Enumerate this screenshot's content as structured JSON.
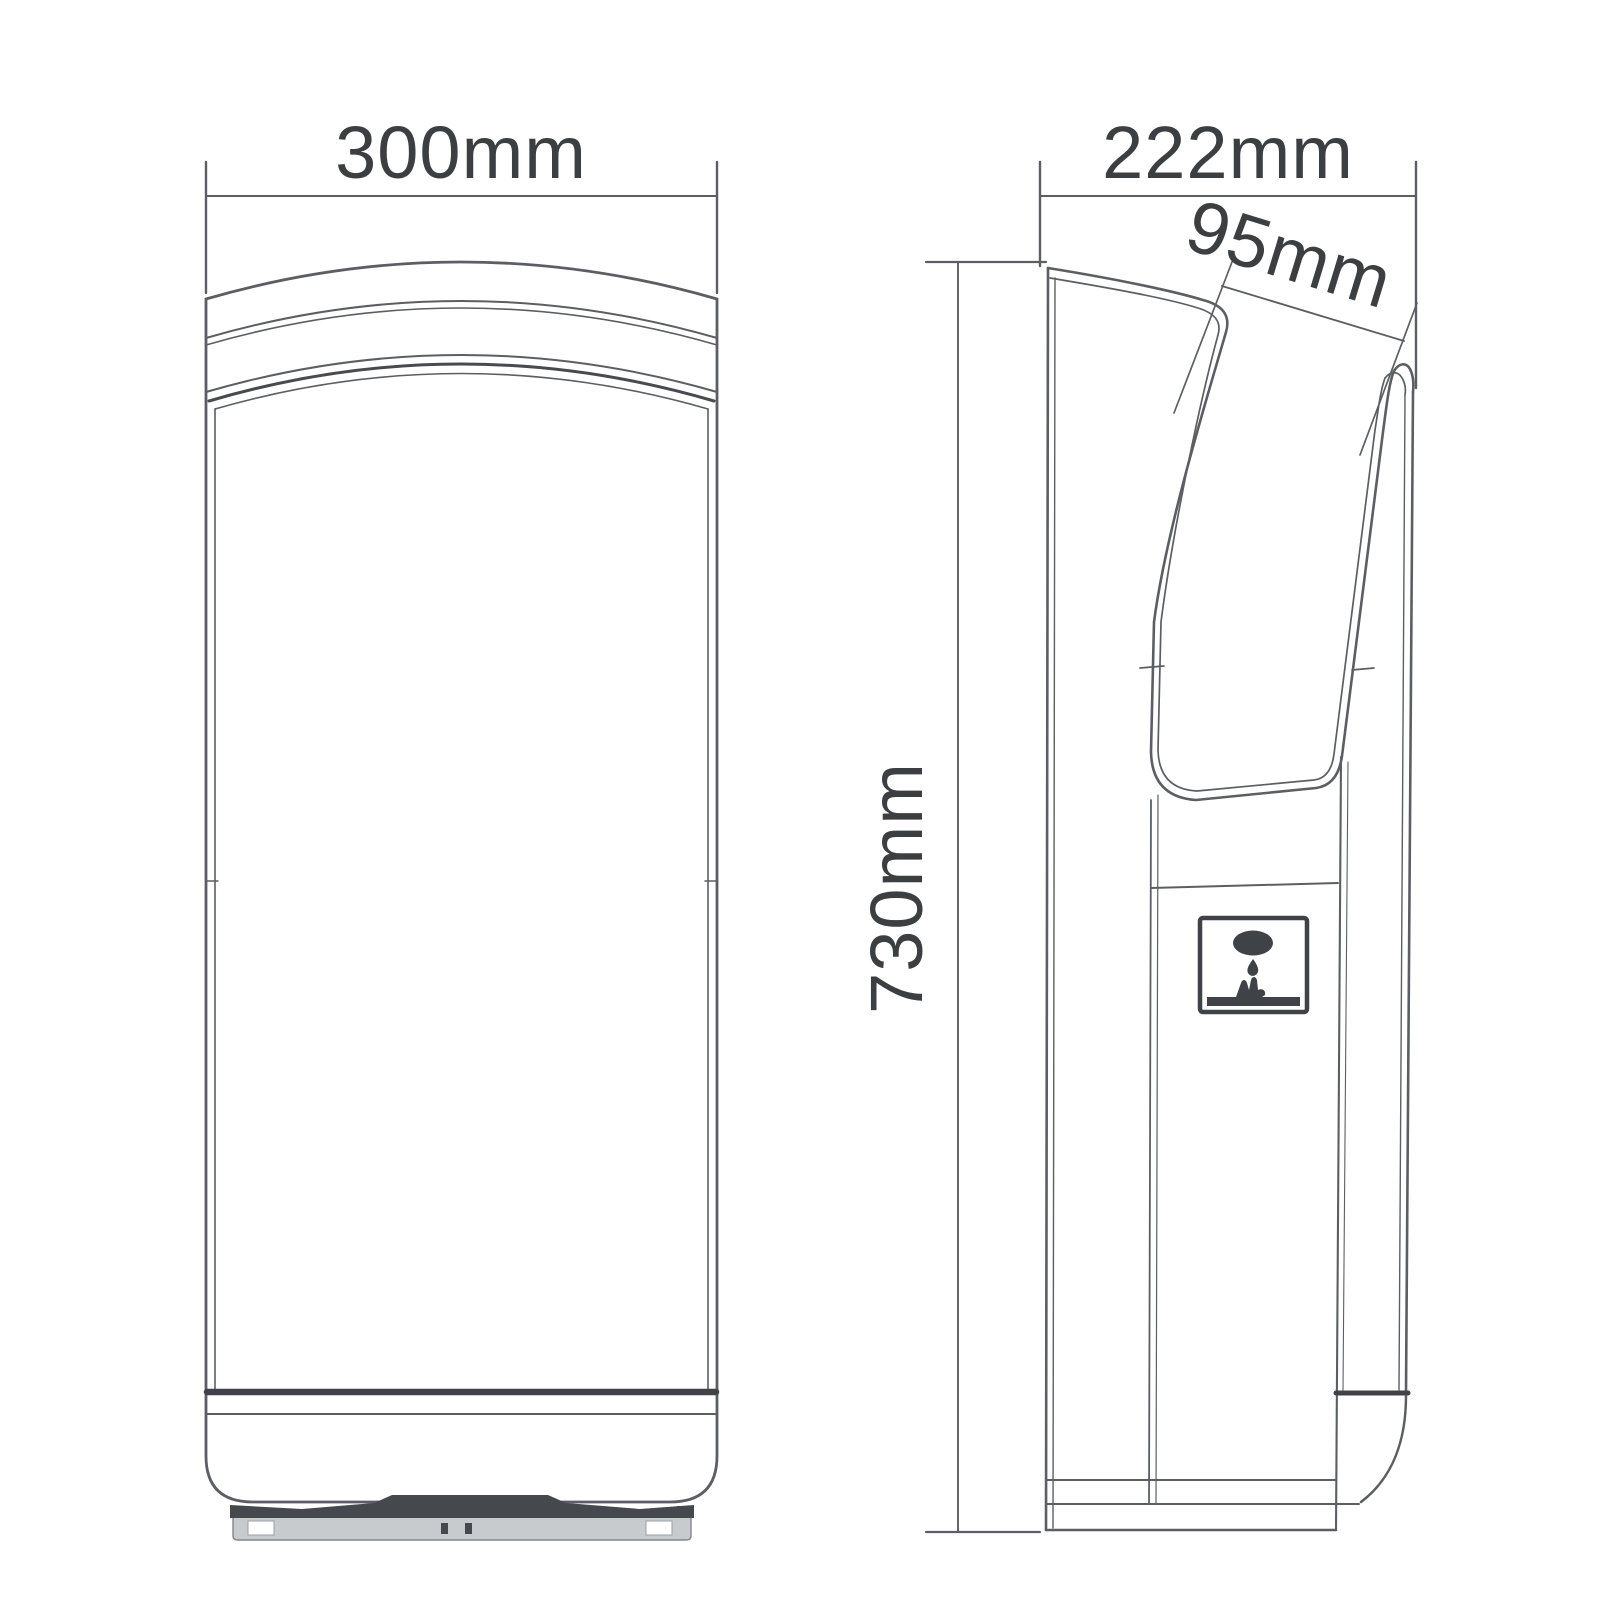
{
  "diagram": {
    "type": "technical-drawing",
    "subject": "jet hand dryer - front and side elevation views with dimensions",
    "views": {
      "front": {
        "title": "front-elevation"
      },
      "side": {
        "title": "side-elevation"
      }
    },
    "dimensions": [
      {
        "id": "overall-width",
        "label": "300mm",
        "orientation": "horizontal",
        "view": "front"
      },
      {
        "id": "overall-depth",
        "label": "222mm",
        "orientation": "horizontal",
        "view": "side"
      },
      {
        "id": "slot-opening",
        "label": "95mm",
        "orientation": "angled",
        "view": "side"
      },
      {
        "id": "overall-height",
        "label": "730mm",
        "orientation": "vertical",
        "view": "side"
      }
    ],
    "icons": [
      {
        "name": "sensor-socket-icon",
        "description": "panel badge with oval outlet, water drop and hand symbol"
      }
    ],
    "colors": {
      "line": "#5b5f63",
      "dark": "#3f4347",
      "text": "#3c3f42",
      "background": "#ffffff",
      "tray": "#c7cbce"
    }
  }
}
